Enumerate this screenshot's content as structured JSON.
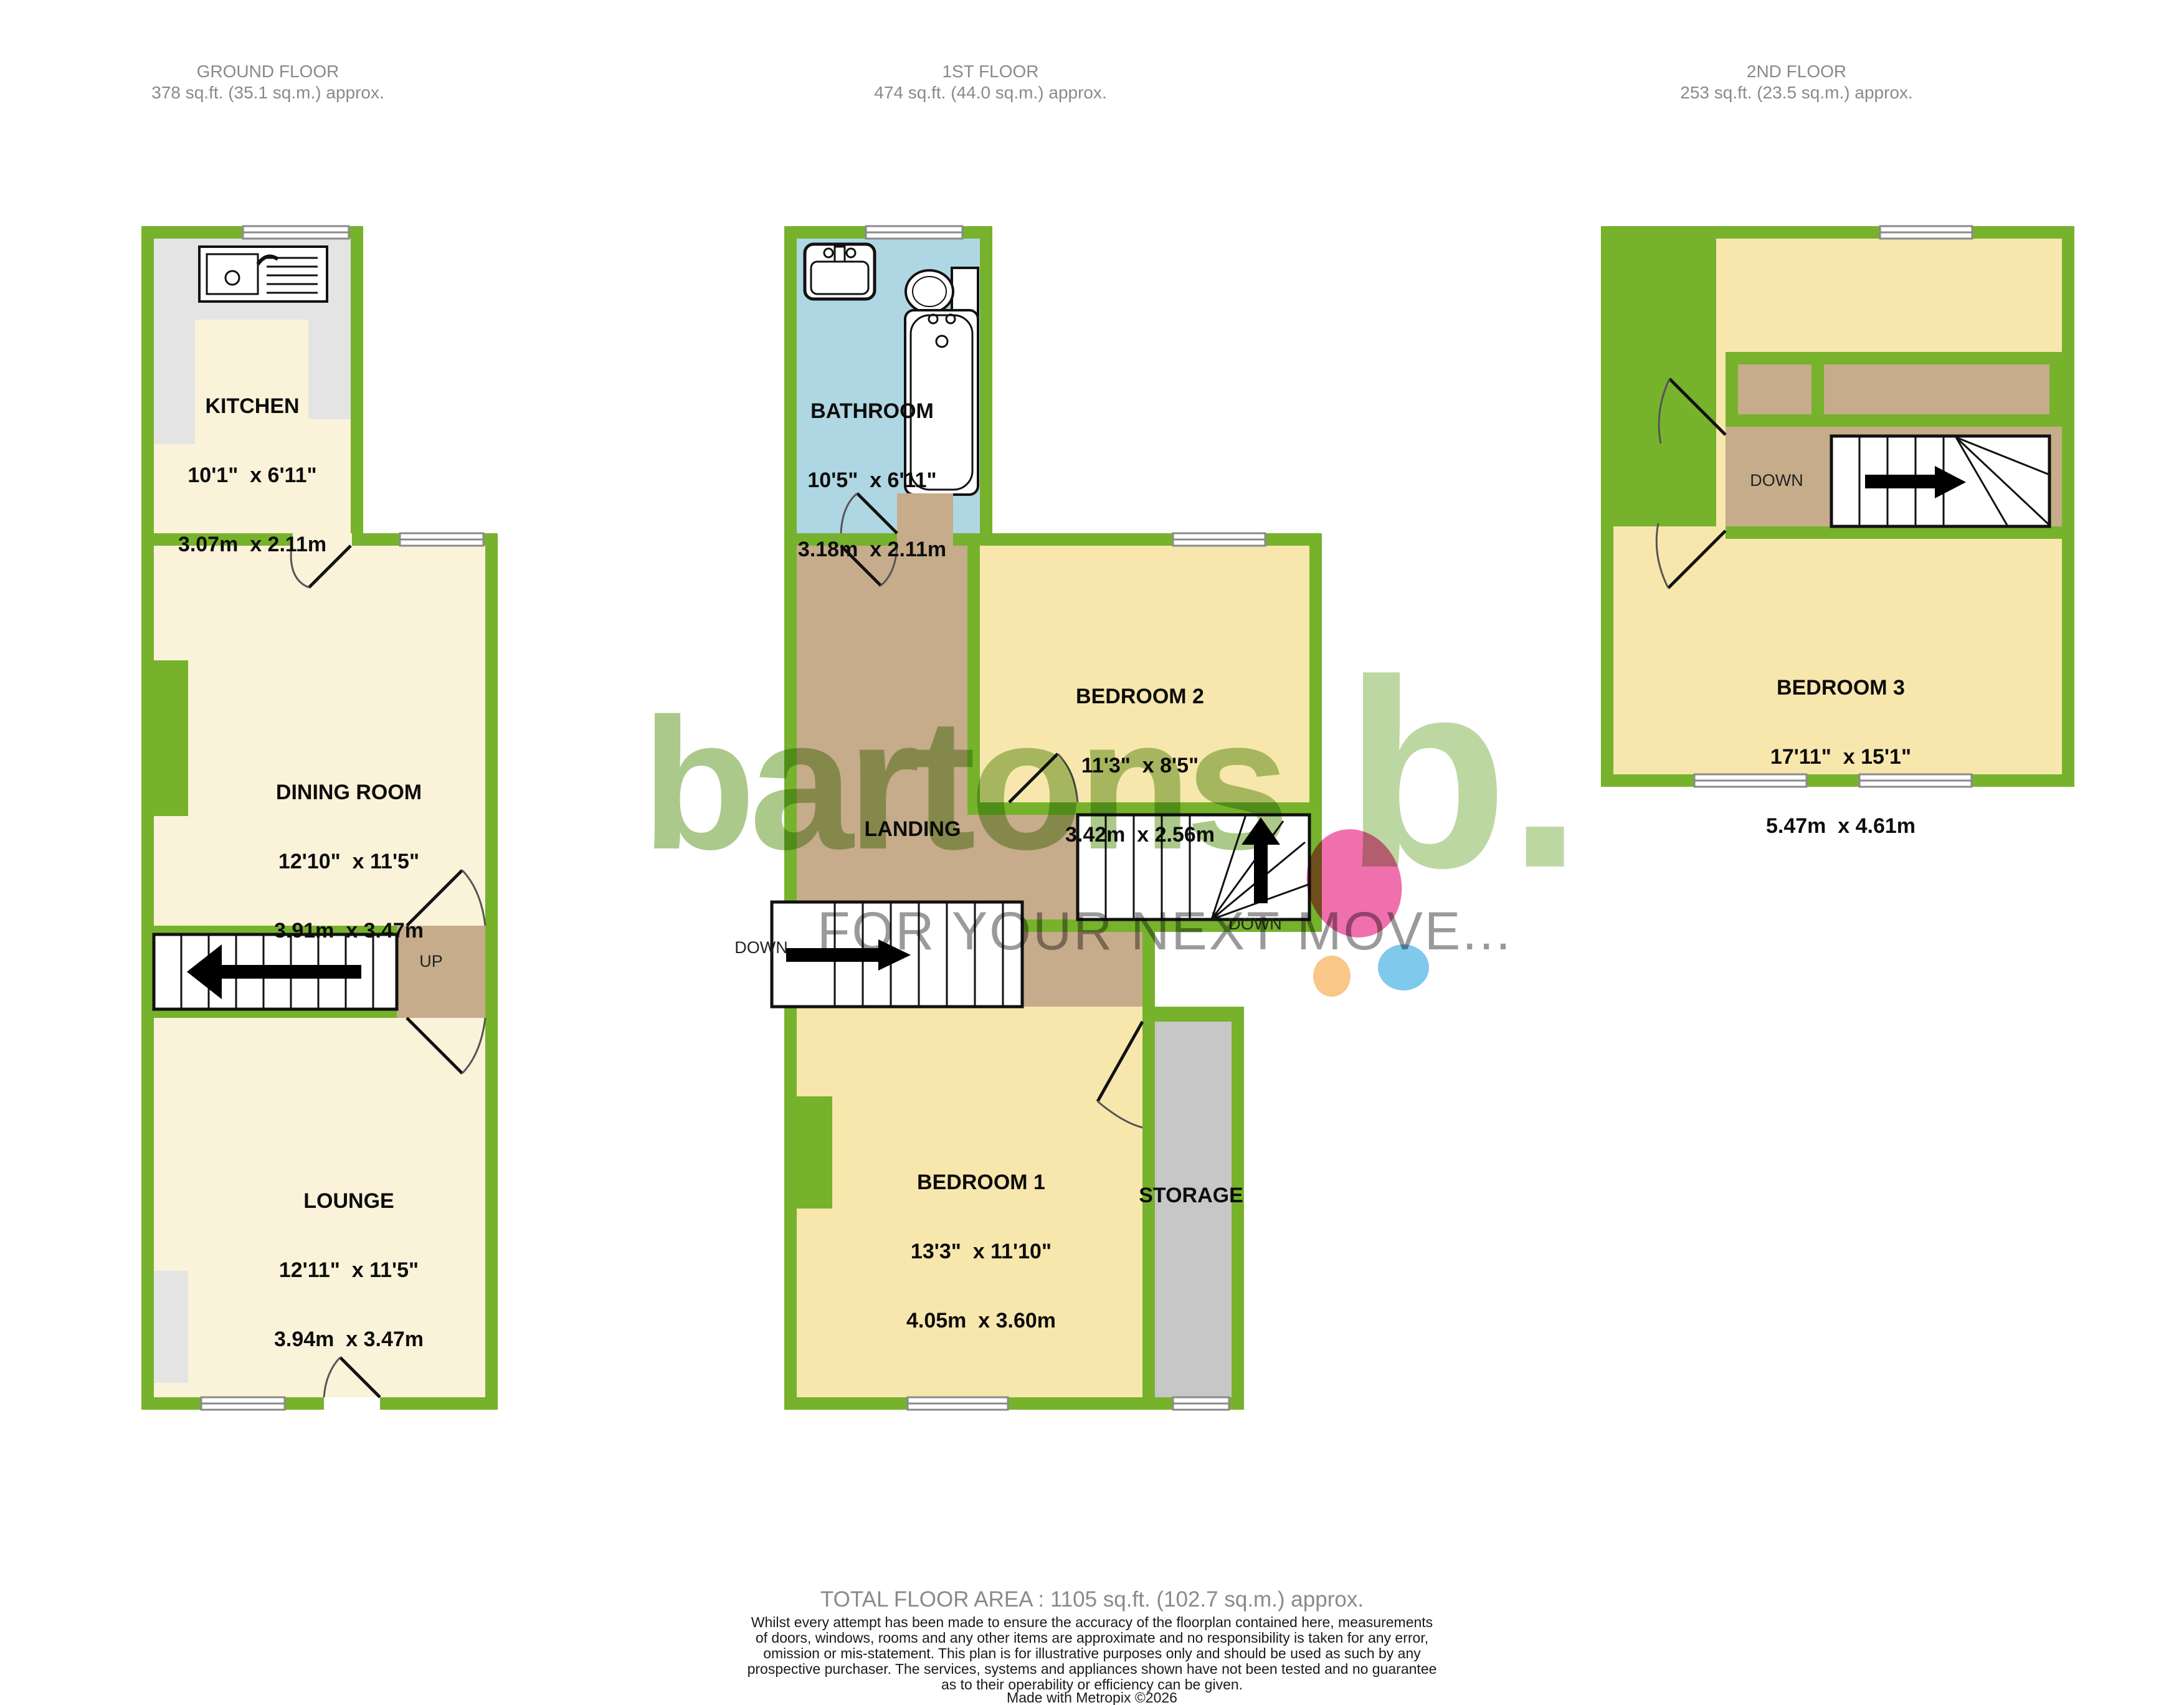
{
  "floors": [
    {
      "label": "GROUND FLOOR",
      "area": "378 sq.ft. (35.1 sq.m.) approx.",
      "rooms": [
        {
          "name": "KITCHEN",
          "imperial": "10'1\"  x 6'11\"",
          "metric": "3.07m  x 2.11m"
        },
        {
          "name": "DINING ROOM",
          "imperial": "12'10\"  x 11'5\"",
          "metric": "3.91m  x 3.47m"
        },
        {
          "name": "LOUNGE",
          "imperial": "12'11\"  x 11'5\"",
          "metric": "3.94m  x 3.47m"
        }
      ],
      "stairs_label": "UP"
    },
    {
      "label": "1ST FLOOR",
      "area": "474 sq.ft. (44.0 sq.m.) approx.",
      "rooms": [
        {
          "name": "BATHROOM",
          "imperial": "10'5\"  x 6'11\"",
          "metric": "3.18m  x 2.11m"
        },
        {
          "name": "BEDROOM 2",
          "imperial": "11'3\"  x 8'5\"",
          "metric": "3.42m  x 2.56m"
        },
        {
          "name": "BEDROOM 1",
          "imperial": "13'3\"  x 11'10\"",
          "metric": "4.05m  x 3.60m"
        }
      ],
      "landing_label": "LANDING",
      "storage_label": "STORAGE",
      "stairs_down_left": "DOWN",
      "stairs_down_right": "DOWN"
    },
    {
      "label": "2ND FLOOR",
      "area": "253 sq.ft. (23.5 sq.m.) approx.",
      "rooms": [
        {
          "name": "BEDROOM 3",
          "imperial": "17'11\"  x 15'1\"",
          "metric": "5.47m  x 4.61m"
        }
      ],
      "stairs_label": "DOWN"
    }
  ],
  "watermark": {
    "brand": "bartons",
    "tagline": "FOR YOUR NEXT MOVE...",
    "monogram": "b."
  },
  "footer": {
    "total_area": "TOTAL FLOOR AREA : 1105 sq.ft. (102.7 sq.m.) approx.",
    "disclaimer": "Whilst every attempt has been made to ensure the accuracy of the floorplan contained here, measurements\nof doors, windows, rooms and any other items are approximate and no responsibility is taken for any error,\nomission or mis-statement. This plan is for illustrative purposes only and should be used as such by any\nprospective purchaser. The services, systems and appliances shown have not been tested and no guarantee\nas to their operability or efficiency can be given.",
    "credit": "Made with Metropix ©2026"
  },
  "colors": {
    "wall_green": "#76B22C",
    "room_cream": "#FAF3DA",
    "bedroom_yellow": "#F8E7AD",
    "bathroom_blue": "#AFD7E3",
    "hall_tan": "#C6AC8B",
    "storage_gray": "#C7C7C7",
    "counter_gray": "#E4E4E4",
    "brand_green": "#ABC98A",
    "tagline_gray": "#9A9A9A",
    "dot_pink": "#F06FAD",
    "dot_blue": "#7FC9ED",
    "dot_orange": "#F9C787"
  }
}
